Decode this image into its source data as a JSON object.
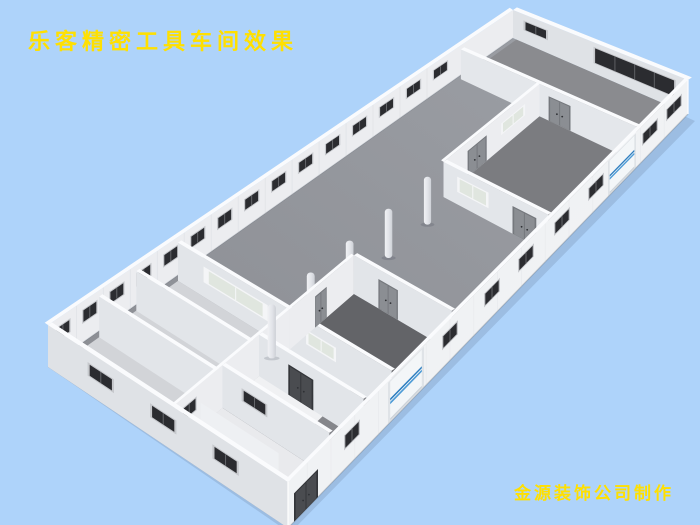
{
  "overlay": {
    "title": "乐客精密工具车间效果",
    "credit": "金源装饰公司制作"
  },
  "scene": {
    "type": "3d-architectural-render",
    "subject": "roofless isometric rendering of a precision tool workshop: long white-walled hall, gray concrete floor, center columns, partitioned office/bath rooms at both ends",
    "background_color": "#aed3fa",
    "text_color": "#ffe000",
    "colors": {
      "floor_main_light": "#9da0a6",
      "floor_main_dark": "#888a90",
      "floor_room_dark": "#636468",
      "floor_room_mid": "#85868b",
      "floor_room_light": "#d2d4d8",
      "floor_room_white": "#e9eaed",
      "floor_corridor_white": "#f0f1f3",
      "wall_bright": "#f3f4f6",
      "wall_inner": "#ecedf0",
      "wall_shaded": "#dfe2e6",
      "wall_part_sw": "#e2e5e9",
      "wall_top": "#fafbfd",
      "seam": "#e1e3e7",
      "window_dark": "#2b2c30",
      "window_frame": "#c6c8cc",
      "window_mullion": "#6a6c70",
      "window_frosted": "#e0e6df",
      "frosted_frame": "#f4f5f7",
      "door_gray": "#8b8e93",
      "door_gray_frame": "#75787d",
      "door_dark": "#4a4c50",
      "door_dark_frame": "#34363a",
      "roller_body": "#f3f6f8",
      "roller_frame": "#dfe3e7",
      "roller_stripe_1": "#4d9bd6",
      "roller_stripe_2": "#2e7ec0",
      "column_light": "#f0f1f4",
      "column_shade": "#cdd0d6",
      "ground_shadow": "rgba(55,65,95,0.15)"
    },
    "counts": {
      "center_columns": 5,
      "back_wall_windows": 15,
      "front_wall_windows": 8,
      "left_end_wall_windows": 3,
      "blue_striped_roller_doors": 2,
      "end_wall_window_band_panes": 4
    }
  }
}
